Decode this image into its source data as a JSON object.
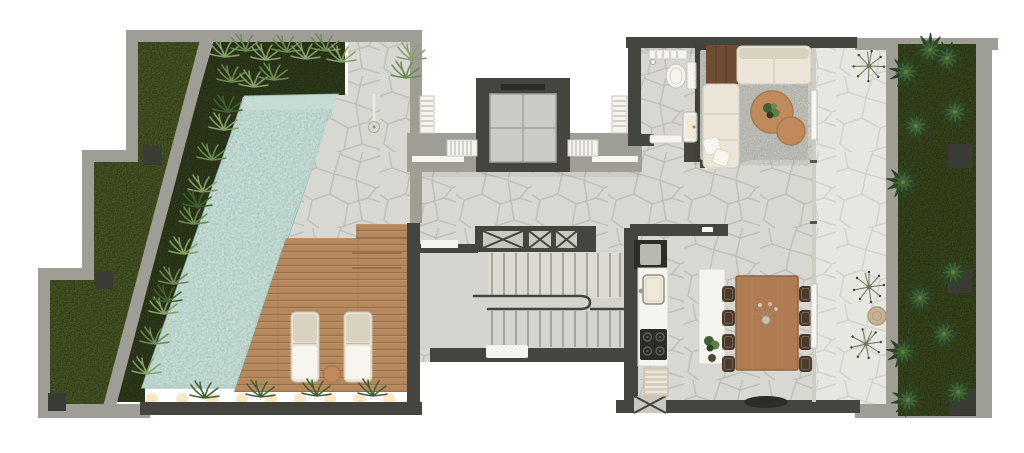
{
  "scene": {
    "type": "architectural-floor-plan-render",
    "view": "top-down",
    "rooms": [
      "lawn-garden",
      "planted-border",
      "swimming-pool",
      "sun-deck",
      "pool-terrace",
      "elevator-lobby",
      "elevator",
      "staircase",
      "bathroom",
      "living-room",
      "entry-hall",
      "dining-area",
      "kitchen",
      "outdoor-terrace",
      "side-garden"
    ],
    "object_counts": {
      "sun_loungers": 2,
      "deck_lights": 9,
      "deck_shrubs": 4,
      "dining_chairs": 8,
      "coffee_tables": 2,
      "sofa_sections": 2,
      "cooktop_burners": 4,
      "lawn_wall_posts": 3,
      "garden_planters": 3,
      "louver_vents": 4,
      "x_braced_vents": 4,
      "fan_plants": 3,
      "rattan_stool": 1,
      "outdoor_shower": 1,
      "elevators": 1,
      "stair_flights": 2
    }
  },
  "colors": {
    "wall": "#9e9e96",
    "wallLight": "#b6b6ae",
    "wallDark": "#45453f",
    "stoneBase": "#d8d8d2",
    "stoneJoint": "#bfbfb7",
    "stoneOut": "#e7e7e2",
    "stoneOutJoint": "#d2d2cb",
    "concrete": "#d4d4ce",
    "concrete2": "#dcdad2",
    "lawn": "#4f5c28",
    "bed": "#323e1d",
    "garden": "#3c4a1f",
    "plantDark": "#2c4526",
    "plantMid": "#416132",
    "plantLight": "#5f7f47",
    "fern": "#85a06b",
    "fern2": "#6d8a55",
    "pool": "#a7c6be",
    "poolLight": "#c6ddd5",
    "poolEdge": "#8fb3ab",
    "deck": "#b5895d",
    "deckGap": "#97704b",
    "deckLight": "#c99d6e",
    "white": "#f5f4ef",
    "cream": "#eae5d7",
    "cushion": "#d9d2c1",
    "pillow": "#f7f5ee",
    "rug": "#c6c6c0",
    "woodDark": "#6e4c34",
    "tableWood": "#ae7b52",
    "tableEdge": "#8f6542",
    "chair": "#4a3a2e",
    "tan": "#c08a5c",
    "tanDark": "#a9784e",
    "rattan": "#c9b295",
    "applianceDark": "#2d2d28",
    "sinkCream": "#f0e9d6",
    "steel": "#9a9a92",
    "glass": "#cdcdc6",
    "lightGlow": "#f2c87e",
    "lightCore": "#ffe9bb",
    "post": "#3b3b36",
    "fanline": "#70755f",
    "fantip": "#3e4336"
  }
}
